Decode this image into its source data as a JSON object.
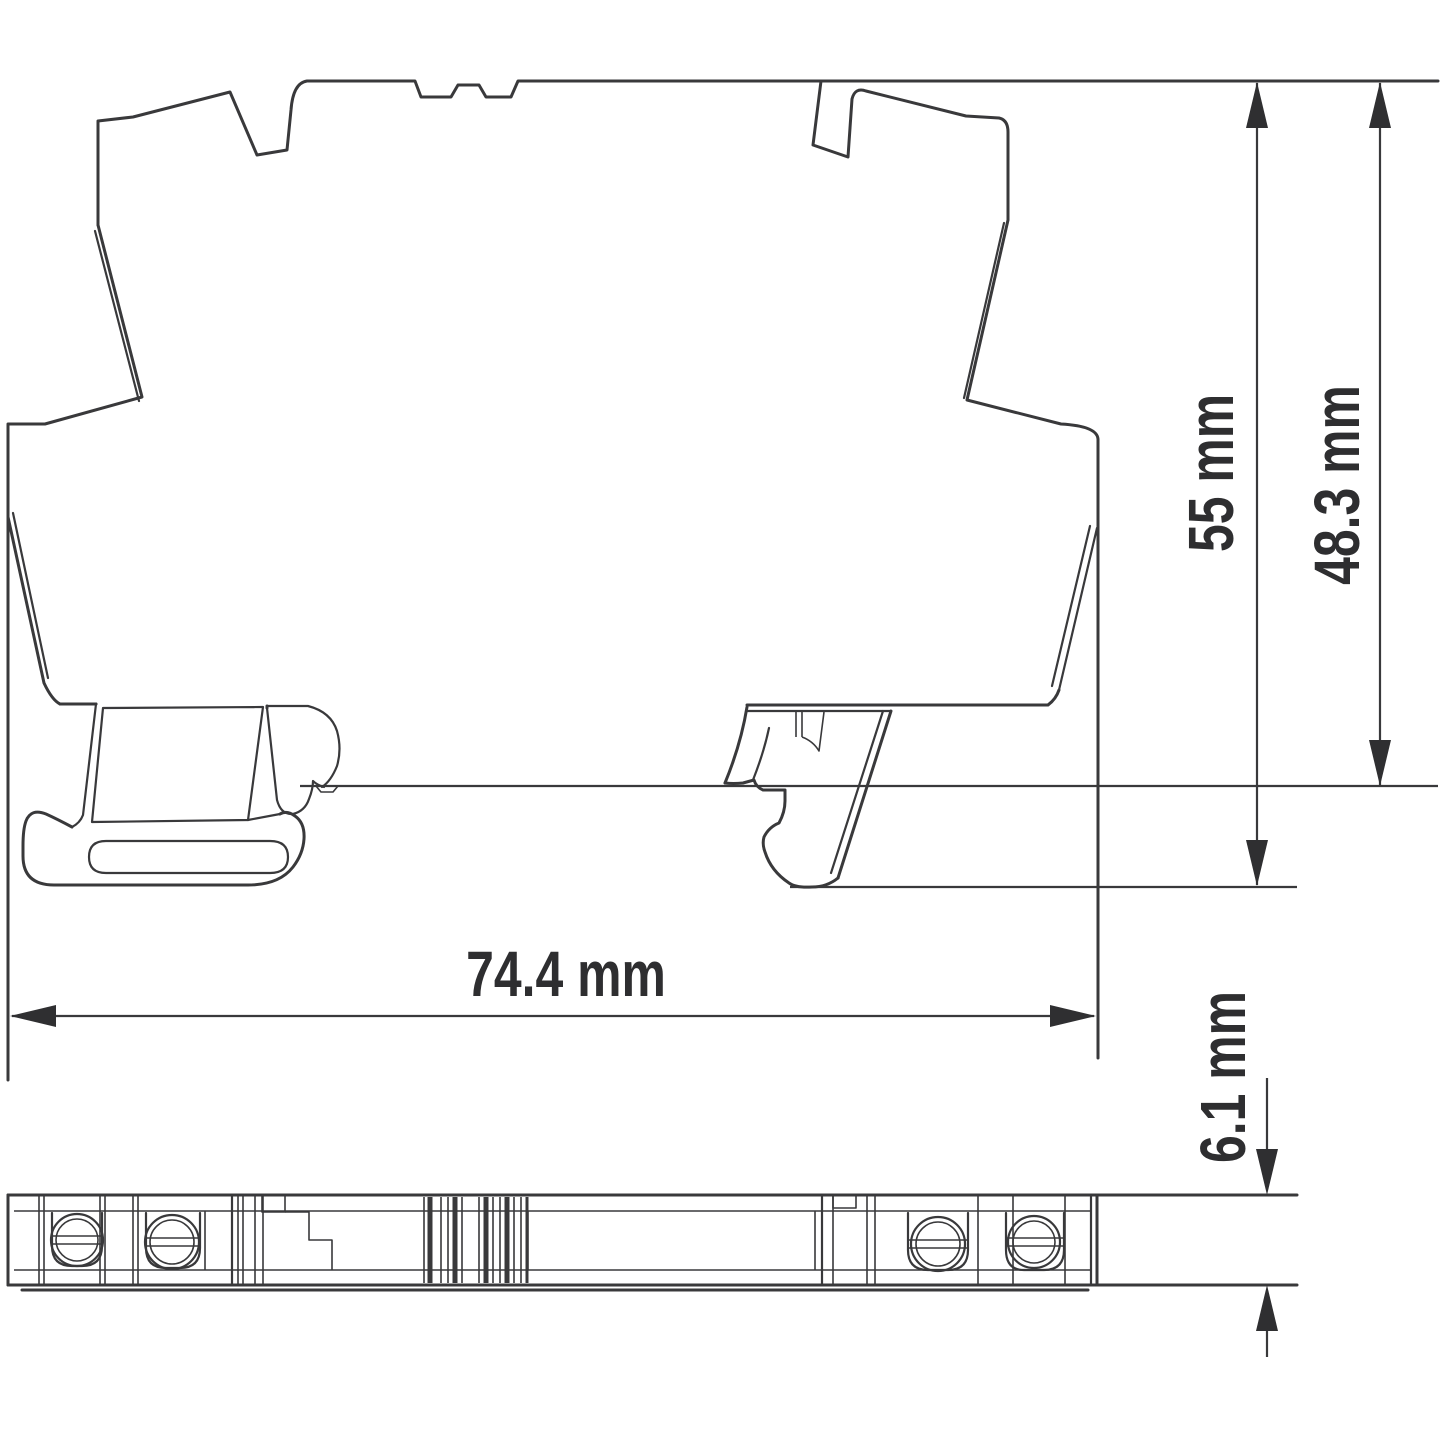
{
  "drawing": {
    "background_color": "#ffffff",
    "line_color": "#39393b",
    "text_color": "#2e2e30"
  },
  "dimensions": {
    "total_height": "55 mm",
    "rail_height": "48.3 mm",
    "depth": "74.4 mm",
    "width": "6.1 mm"
  }
}
